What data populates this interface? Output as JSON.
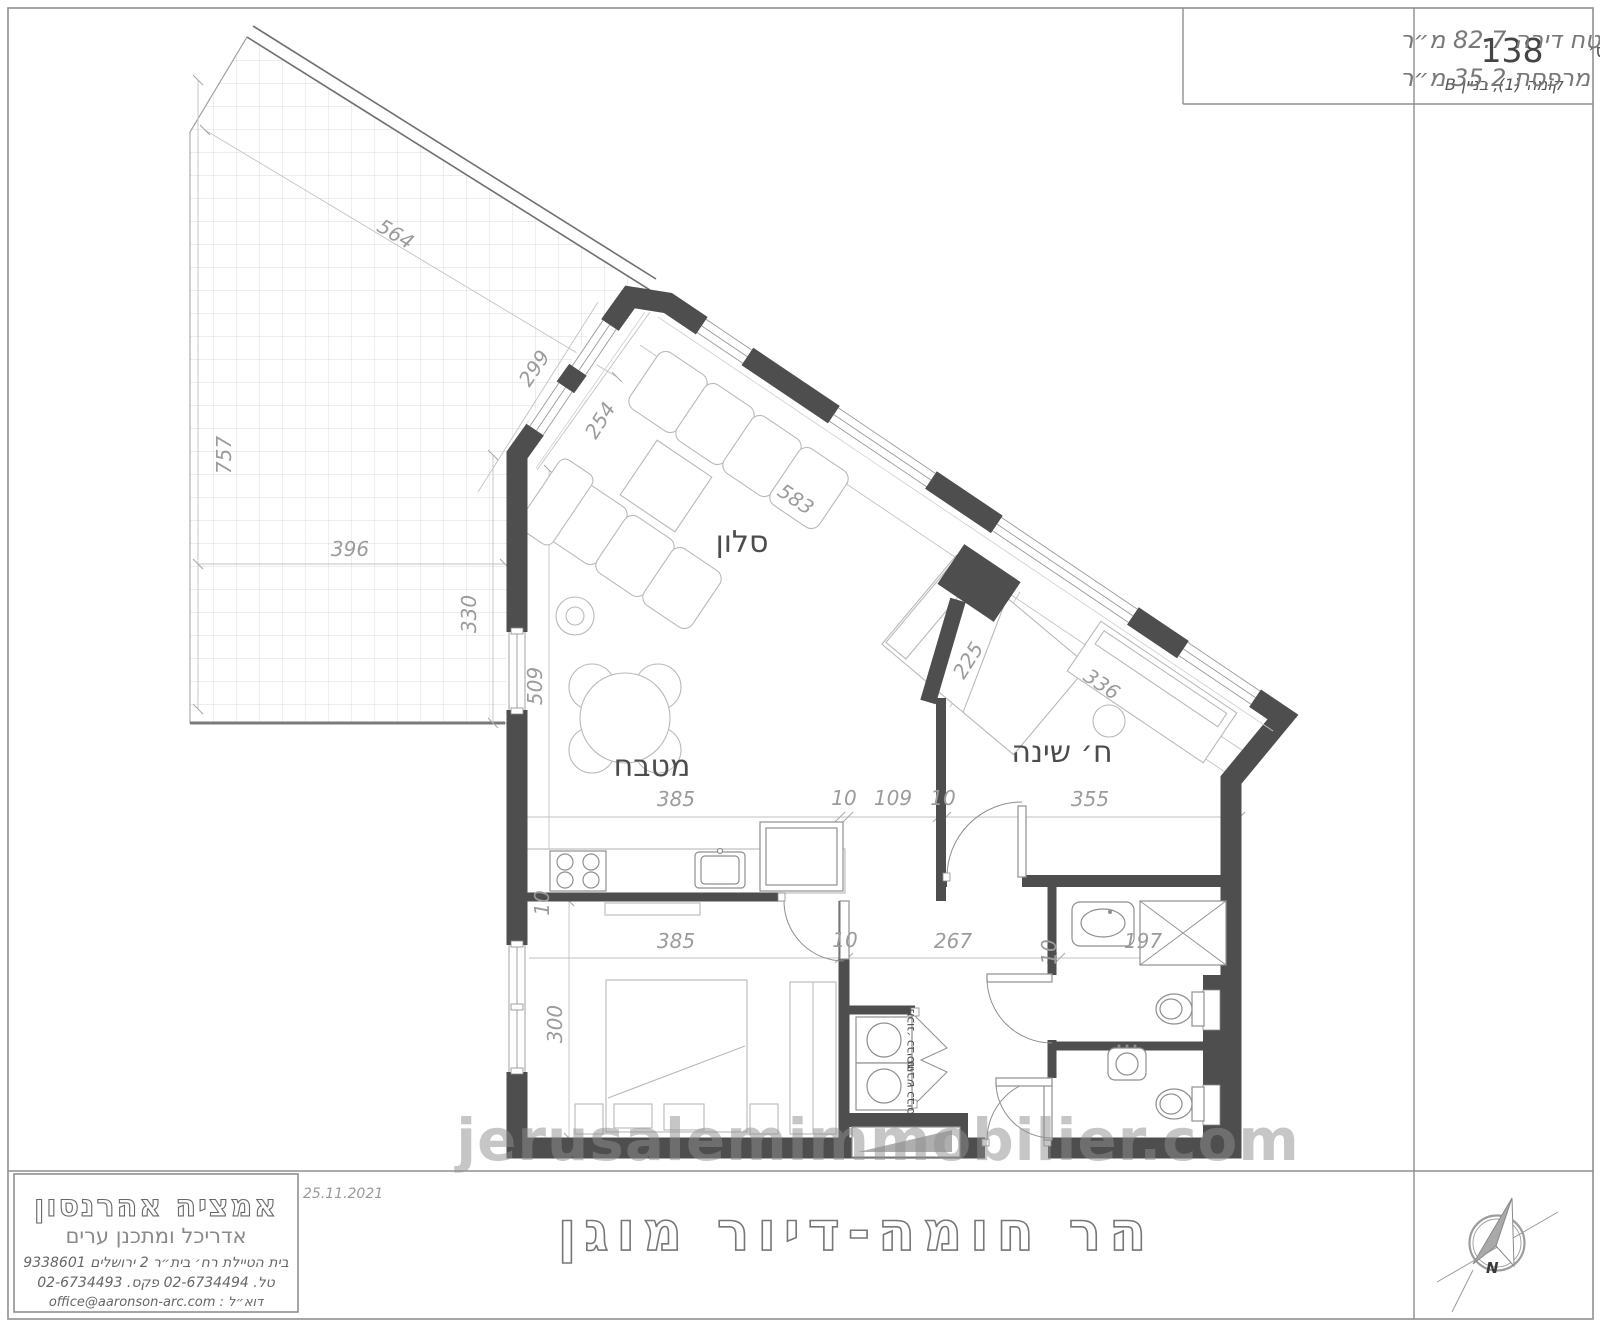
{
  "sheet": {
    "apartment_box": {
      "label": "דירה מס׳",
      "number": "138",
      "floor": "קומה (1), בניין B"
    },
    "area_box": {
      "line1": "שטח דירה  82.7 מ״ר",
      "line2": "שטח מרפסת  35.2 מ״ר"
    },
    "title_strip": {
      "date": "25.11.2021",
      "project_title": "הר חומה-דיור מוגן"
    },
    "architect": {
      "name": "אמציה אהרנסון",
      "role": "אדריכל ומתכנן ערים",
      "address": "בית הטיילת  רח׳ בית״ר  2  ירושלים  9338601",
      "phone_fax": "טל. 02-6734494  פקס. 02-6734493",
      "email": "דוא״ל :  office@aaronson-arc.com"
    },
    "compass": {
      "north_label": "N"
    }
  },
  "watermark": "jerusalemimmobilier.com",
  "plan": {
    "room_labels": [
      {
        "text": "סלון",
        "x": 742,
        "y": 552,
        "size": 30,
        "rot": 0
      },
      {
        "text": "מטבח",
        "x": 652,
        "y": 776,
        "size": 30,
        "rot": 0
      },
      {
        "text": "ח׳ שינה",
        "x": 1062,
        "y": 762,
        "size": 30,
        "rot": 0
      },
      {
        "text": "מכונ׳ כביסה",
        "x": 914,
        "y": 1040,
        "size": 12,
        "rot": -90
      },
      {
        "text": "מיבש כביסה",
        "x": 914,
        "y": 1092,
        "size": 12,
        "rot": -90
      }
    ],
    "dimension_labels": [
      {
        "text": "564",
        "x": 392,
        "y": 240,
        "rot": 31
      },
      {
        "text": "299",
        "x": 540,
        "y": 372,
        "rot": -56
      },
      {
        "text": "757",
        "x": 231,
        "y": 455,
        "rot": -90
      },
      {
        "text": "396",
        "x": 350,
        "y": 556,
        "rot": 0
      },
      {
        "text": "330",
        "x": 476,
        "y": 614,
        "rot": -90
      },
      {
        "text": "254",
        "x": 606,
        "y": 424,
        "rot": -58
      },
      {
        "text": "583",
        "x": 792,
        "y": 505,
        "rot": 34
      },
      {
        "text": "509",
        "x": 542,
        "y": 686,
        "rot": -90
      },
      {
        "text": "336",
        "x": 1098,
        "y": 690,
        "rot": 34
      },
      {
        "text": "225",
        "x": 974,
        "y": 664,
        "rot": -58
      },
      {
        "text": "385",
        "x": 676,
        "y": 806,
        "rot": 0
      },
      {
        "text": "10",
        "x": 844,
        "y": 805,
        "rot": 0
      },
      {
        "text": "109",
        "x": 893,
        "y": 805,
        "rot": 0
      },
      {
        "text": "10",
        "x": 943,
        "y": 805,
        "rot": 0
      },
      {
        "text": "355",
        "x": 1090,
        "y": 806,
        "rot": 0
      },
      {
        "text": "385",
        "x": 676,
        "y": 948,
        "rot": 0
      },
      {
        "text": "10",
        "x": 845,
        "y": 947,
        "rot": 0
      },
      {
        "text": "267",
        "x": 953,
        "y": 948,
        "rot": 0
      },
      {
        "text": "10",
        "x": 1056,
        "y": 952,
        "rot": -90
      },
      {
        "text": "197",
        "x": 1143,
        "y": 948,
        "rot": 0
      },
      {
        "text": "300",
        "x": 562,
        "y": 1024,
        "rot": -90
      },
      {
        "text": "10",
        "x": 549,
        "y": 903,
        "rot": -90
      }
    ]
  }
}
